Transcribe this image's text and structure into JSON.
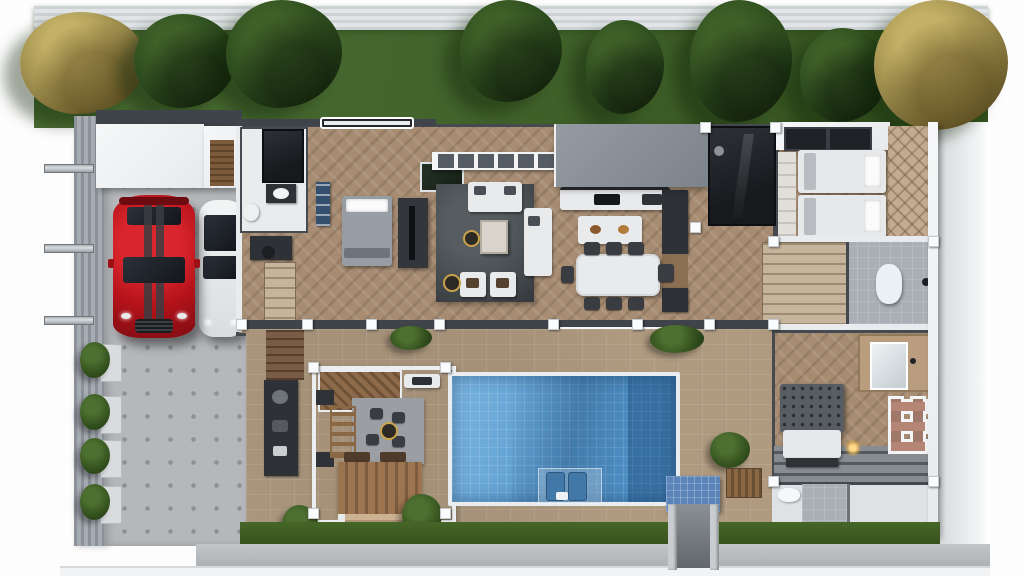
{
  "scene": {
    "description": "3D rendered top-down floor plan of a modern single-storey villa with back lawn and trees, left carport with two cars, central open-plan living-kitchen-dining wing, three bedrooms, bathrooms, inner courtyard with pergola lounge, wooden deck and tiled swimming pool with sun loungers"
  },
  "palette": {
    "lawn_light": "#4c6e34",
    "lawn_dark": "#33511e",
    "tree_dark_hi": "#3f6128",
    "tree_dark_mid": "#2c4a1d",
    "tree_dark_lo": "#1d3312",
    "tree_gold_hi": "#c4b166",
    "tree_gold_mid": "#99894a",
    "tree_gold_lo": "#6b5e2e",
    "fence_top": "#e1e5e7",
    "fence_left_a": "#8b9198",
    "fence_left_b": "#a6acb2",
    "drive": "#b5b7bb",
    "drive_dot": "#8f9195",
    "tile": "#af9a80",
    "wood": "#a78c72",
    "wall_dark": "#3f444a",
    "roof_gray_a": "#959ba3",
    "roof_gray_b": "#7c838b",
    "roof_white": "#e7eaec",
    "dark_room": "#17191d",
    "rug_dark": "#43484c",
    "sofa_white": "#e9eaec",
    "pool_hi": "#7ab5e0",
    "pool_mid": "#5396cb",
    "pool_rim": "#e9edef",
    "car_red": "#b3121a",
    "car_red_dark": "#7e0d12",
    "car_white": "#dadde0",
    "deck_a": "#9c7450",
    "deck_b": "#7d5c3e",
    "counter_dark": "#2e3136",
    "cabinet_wood": "#8a6f52",
    "closet_beige": "#c7b49c",
    "bed_gray": "#979da5",
    "bed_white": "#e7e8ea",
    "chevron_base": "#c3ab90",
    "grass_strip_a": "#466628",
    "grass_strip_b": "#36511d",
    "walkway_a": "#c3c6c9",
    "walkway_b": "#adb0b3",
    "bath_tile": "#a9afb4",
    "gold": "#c9a24a",
    "brick": "#7a5b45",
    "ramp_blue": "#5b84b8"
  }
}
